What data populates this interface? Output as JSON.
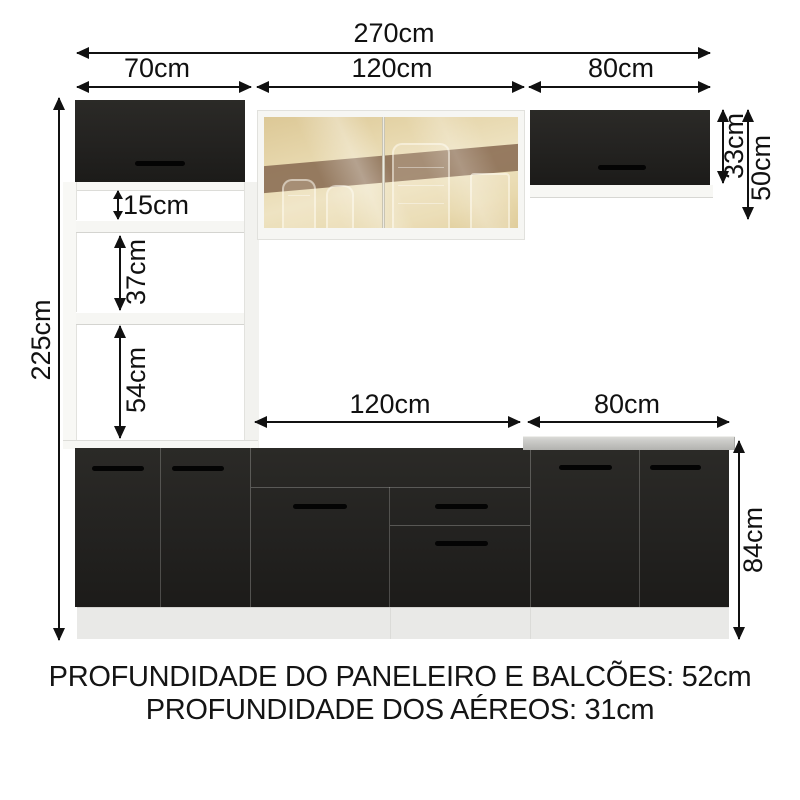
{
  "dimensions": {
    "total_width": "270cm",
    "upper_left_width": "70cm",
    "upper_middle_width": "120cm",
    "upper_right_width": "80cm",
    "total_height": "225cm",
    "niche_top_height": "15cm",
    "niche_middle_height": "37cm",
    "niche_bottom_height": "54cm",
    "upper_right_cabinet_height": "33cm",
    "upper_right_total_height": "50cm",
    "base_middle_width": "120cm",
    "base_right_width": "80cm",
    "base_height": "84cm"
  },
  "footer": {
    "line1": "PROFUNDIDADE DO PANELEIRO E BALCÕES: 52cm",
    "line2": "PROFUNDIDADE DOS AÉREOS: 31cm"
  },
  "colors": {
    "cabinet_black": "#232220",
    "dimension_ink": "#111111",
    "countertop_gray": "#c0c0bd",
    "glass_amber": "#e6d6ab",
    "glass_band_brown": "#8c6f55",
    "frame_white": "#f6f6f3",
    "plinth_gray": "#e9e9e7",
    "background": "#ffffff"
  }
}
